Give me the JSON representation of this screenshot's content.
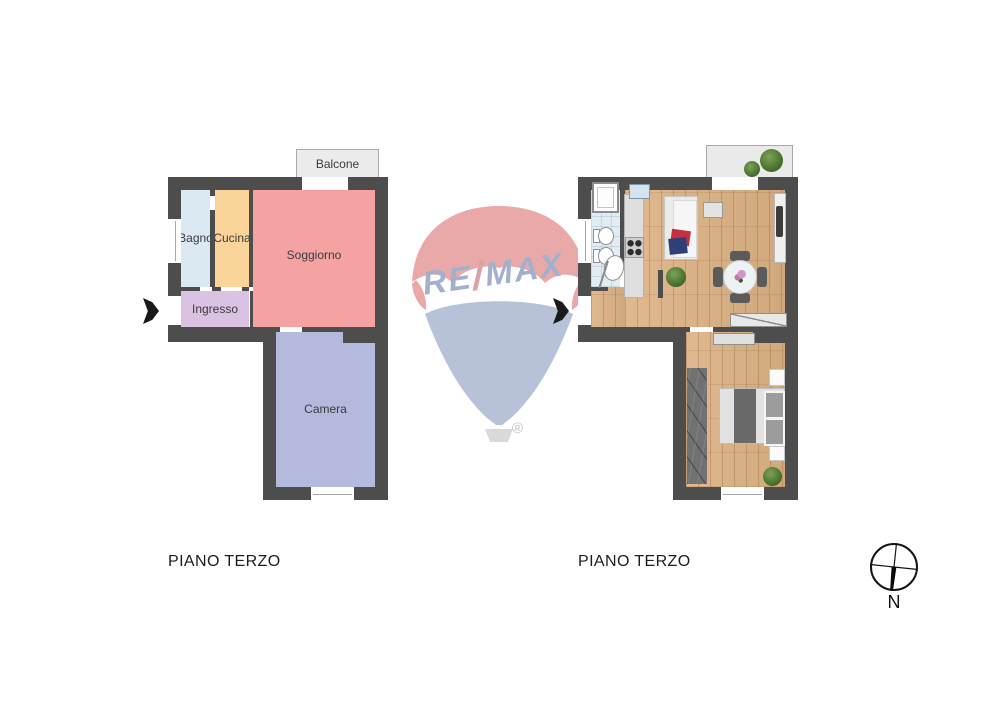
{
  "left_plan": {
    "caption": "PIANO TERZO",
    "wall_color": "#4d4d4d",
    "balcony": {
      "label": "Balcone",
      "color": "#ececec"
    },
    "rooms": [
      {
        "label": "Bagno",
        "color": "#dbe9f2"
      },
      {
        "label": "Cucina",
        "color": "#fbd499"
      },
      {
        "label": "Soggiorno",
        "color": "#f4a2a2"
      },
      {
        "label": "Ingresso",
        "color": "#dbc1e2"
      },
      {
        "label": "Camera",
        "color": "#b4bade"
      }
    ]
  },
  "right_plan": {
    "caption": "PIANO TERZO",
    "wall_color": "#4d4d4d",
    "wood_floor_color": "#dcb183",
    "bathroom_floor_color": "#e2edf3",
    "balcony_color": "#eaeaea"
  },
  "watermark": {
    "re": "RE",
    "slash": "/",
    "max": "MAX",
    "registered": "®",
    "letter_color": "#a2b0ce",
    "slash_color": "#dba3a3",
    "canopy_color": "#e9a9a9",
    "envelope_color": "#b7c2d8",
    "basket_color": "#d9d9d9"
  },
  "compass": {
    "label": "N"
  }
}
